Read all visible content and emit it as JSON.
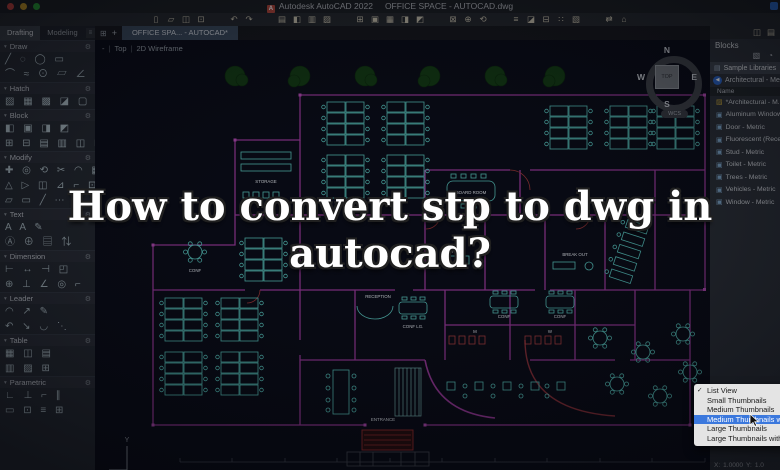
{
  "window": {
    "app_title": "Autodesk AutoCAD 2022",
    "doc_title": "OFFICE SPACE - AUTOCAD.dwg",
    "app_icon_letter": "A"
  },
  "colors": {
    "accent_blue": "#3b78dd",
    "wall_magenta": "#9b3a9b",
    "furniture_teal": "#5ac8c0",
    "alert_red": "#b04040",
    "tree_green": "#143c14",
    "canvas_bg": "#0a0d17"
  },
  "toolbar": {
    "icons": [
      {
        "name": "new-file-icon",
        "glyph": "▯"
      },
      {
        "name": "open-folder-icon",
        "glyph": "▱"
      },
      {
        "name": "save-icon",
        "glyph": "◫"
      },
      {
        "name": "save-as-icon",
        "glyph": "⊡"
      },
      {
        "name": "toolbar-spacer",
        "glyph": "",
        "state": "spacer"
      },
      {
        "name": "undo-icon",
        "glyph": "↶"
      },
      {
        "name": "redo-icon",
        "glyph": "↷"
      },
      {
        "name": "toolbar-spacer",
        "glyph": "",
        "state": "spacer"
      },
      {
        "name": "print-icon",
        "glyph": "▤"
      },
      {
        "name": "plot-icon",
        "glyph": "◧"
      },
      {
        "name": "page-setup-icon",
        "glyph": "▥"
      },
      {
        "name": "publish-icon",
        "glyph": "▨"
      },
      {
        "name": "toolbar-spacer",
        "glyph": "",
        "state": "spacer"
      },
      {
        "name": "insert-block-icon",
        "glyph": "⊞"
      },
      {
        "name": "attach-xref-icon",
        "glyph": "▣"
      },
      {
        "name": "attach-image-icon",
        "glyph": "▦"
      },
      {
        "name": "field-icon",
        "glyph": "◨"
      },
      {
        "name": "ole-object-icon",
        "glyph": "◩"
      },
      {
        "name": "toolbar-spacer",
        "glyph": "",
        "state": "spacer"
      },
      {
        "name": "zoom-window-icon",
        "glyph": "⊠"
      },
      {
        "name": "pan-icon",
        "glyph": "⊕"
      },
      {
        "name": "orbit-icon",
        "glyph": "⟲"
      },
      {
        "name": "toolbar-spacer",
        "glyph": "",
        "state": "spacer"
      },
      {
        "name": "layer-properties-icon",
        "glyph": "≡"
      },
      {
        "name": "properties-icon",
        "glyph": "◪"
      },
      {
        "name": "match-properties-icon",
        "glyph": "⊟"
      },
      {
        "name": "measure-icon",
        "glyph": "∷"
      },
      {
        "name": "paste-icon",
        "glyph": "▧"
      },
      {
        "name": "toolbar-spacer",
        "glyph": "",
        "state": "spacer"
      },
      {
        "name": "sheet-set-icon",
        "glyph": "⇄"
      },
      {
        "name": "purge-icon",
        "glyph": "⌂"
      }
    ]
  },
  "workspace_tabs": {
    "drafting": "Drafting",
    "modeling": "Modeling",
    "overflow_glyph": "≡"
  },
  "doc_tab": {
    "layout_grid_glyph": "⊞",
    "new_tab_glyph": "+",
    "title": "OFFICE SPA... - AUTOCAD*"
  },
  "viewport": {
    "pane": "-",
    "view": "Top",
    "style": "2D Wireframe",
    "sep": "|"
  },
  "viewcube": {
    "north": "N",
    "south": "S",
    "east": "E",
    "west": "W",
    "top": "TOP",
    "wcs": "WCS"
  },
  "palette": {
    "collapse_glyph": "▾",
    "gear_glyph": "⚙",
    "sections": [
      {
        "label": "Draw",
        "rows": {
          "r1": "╱ ◌ ◯ ▭",
          "r2": "⌒ ≈ ⊙ ▱ ∠ ◠ ⋱"
        }
      },
      {
        "label": "Hatch",
        "rows": {
          "r1": "▨ ▦ ▩ ◪ ▢"
        }
      },
      {
        "label": "Block",
        "rows": {
          "r1": "◧ ▣ ◨ ◩",
          "r2": "⊞ ⊟ ▤ ▥ ◫ ⊠"
        }
      },
      {
        "label": "Modify",
        "rows": {
          "r1": "✚ ◎ ⟲ ✂ ◠ ▦",
          "r2": "△ ▷ ◫ ⊿ ⌐ ⊡",
          "r3": "▱ ▭ ╱ ⋯ ◨ ⊥"
        }
      },
      {
        "label": "Text",
        "rows": {
          "r1": "A A ✎",
          "r2": "Ⓐ ⊕ ▤ ⇅"
        }
      },
      {
        "label": "Dimension",
        "rows": {
          "r1": "⊢ ↔ ⊣ ◰",
          "r2": "⊕ ⊥ ∠ ◎ ⌐"
        }
      },
      {
        "label": "Leader",
        "rows": {
          "r1": "◠ ↗ ✎",
          "r2": "↶ ↘ ◡ ⋱"
        }
      },
      {
        "label": "Table",
        "rows": {
          "r1": "▦ ◫ ▤",
          "r2": "▥ ▨ ⊞"
        }
      },
      {
        "label": "Parametric",
        "rows": {
          "r1": "∟ ⊥ ⌐ ∥",
          "r2": "▭ ⊡ ≡ ⊞"
        }
      }
    ]
  },
  "blocks_panel": {
    "title": "Blocks",
    "header_icons": [
      {
        "name": "panel-dock-icon",
        "glyph": "◫"
      },
      {
        "name": "panel-menu-icon",
        "glyph": "▤"
      }
    ],
    "action_icons": [
      {
        "name": "filter-folder-icon",
        "glyph": "▧"
      },
      {
        "name": "recent-clock-icon",
        "glyph": "◔"
      }
    ],
    "library_icon": "▤",
    "library_row": "Sample Libraries",
    "back_glyph": "◀",
    "current_library": "Architectural - Me...",
    "name_header": "Name",
    "items": [
      {
        "icon": "▨",
        "type": "folder",
        "label": "*Architectural - M..."
      },
      {
        "icon": "▣",
        "label": "Aluminum Window..."
      },
      {
        "icon": "▣",
        "label": "Door - Metric"
      },
      {
        "icon": "▣",
        "label": "Fluorescent (Rece..."
      },
      {
        "icon": "▣",
        "label": "Stud - Metric"
      },
      {
        "icon": "▣",
        "label": "Toilet - Metric"
      },
      {
        "icon": "▣",
        "label": "Trees - Metric"
      },
      {
        "icon": "▣",
        "label": "Vehicles - Metric"
      },
      {
        "icon": "▣",
        "label": "Window - Metric"
      }
    ]
  },
  "search": {
    "placeholder": "Search"
  },
  "menu": {
    "items": [
      {
        "label": "List View",
        "check": "✓"
      },
      {
        "label": "Small Thumbnails",
        "check": ""
      },
      {
        "label": "Medium Thumbnails",
        "check": ""
      },
      {
        "label": "Medium Thumbnails wit",
        "check": "",
        "state": "selected"
      },
      {
        "label": "Large Thumbnails",
        "check": ""
      },
      {
        "label": "Large Thumbnails with",
        "check": ""
      }
    ]
  },
  "insert_options": {
    "x_label": "X:",
    "x_value": "1.0000",
    "y_label": "Y:",
    "y_value": "1.0",
    "rotation_label": "Rotation",
    "rotation_value": "0"
  },
  "headline": {
    "line1": "How to convert stp to dwg in",
    "line2": "autocad?"
  },
  "plan": {
    "ucs_y": "Y",
    "labels": {
      "storage": "STORAGE",
      "board_room": "BOARD ROOM",
      "break_out": "BREAK OUT",
      "reception": "RECEPTION",
      "entrance": "ENTRANCE",
      "conf_lg": "CONF LG.",
      "conf_a": "CONF",
      "conf_b": "CONF",
      "conf_c": "CONF",
      "quiet": "QUIET",
      "mens": "M",
      "womens": "W"
    }
  }
}
